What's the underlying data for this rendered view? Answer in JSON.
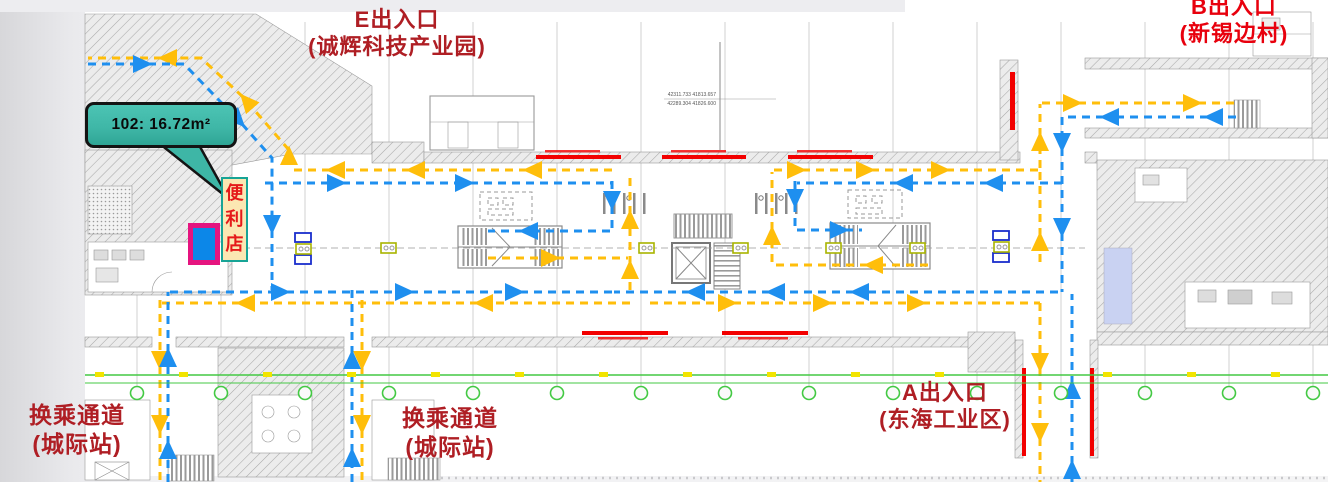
{
  "callout": {
    "room_label": "102: 16.72m²"
  },
  "store": {
    "label": "便利店"
  },
  "entrances": {
    "e": {
      "name": "E出入口",
      "note": "(诚辉科技产业园)"
    },
    "b": {
      "name": "B出入口",
      "note": "(新锡边村)"
    },
    "a": {
      "name": "A出入口",
      "note": "(东海工业区)"
    }
  },
  "transfer_passages": {
    "left": {
      "name": "换乘通道",
      "note": "(城际站)"
    },
    "middle": {
      "name": "换乘通道",
      "note": "(城际站)"
    }
  },
  "survey_coords": {
    "line1": "42311.733  41813.657",
    "line2": "42289.304  41826.600"
  },
  "colors": {
    "entry_flow_blue": "#1E8FEF",
    "exit_flow_yellow": "#FFBE0A",
    "callout_teal": "#3EB6A6",
    "store_fill": "#FBE7B2",
    "store_border": "#17A496",
    "label_dark_red": "#AF1E24",
    "label_bright_red": "#E8000D",
    "fire_shutter_red": "#F20000",
    "survey_green": "#43C943",
    "highlight_magenta": "#E5147F",
    "highlight_blue": "#0C87E8"
  }
}
